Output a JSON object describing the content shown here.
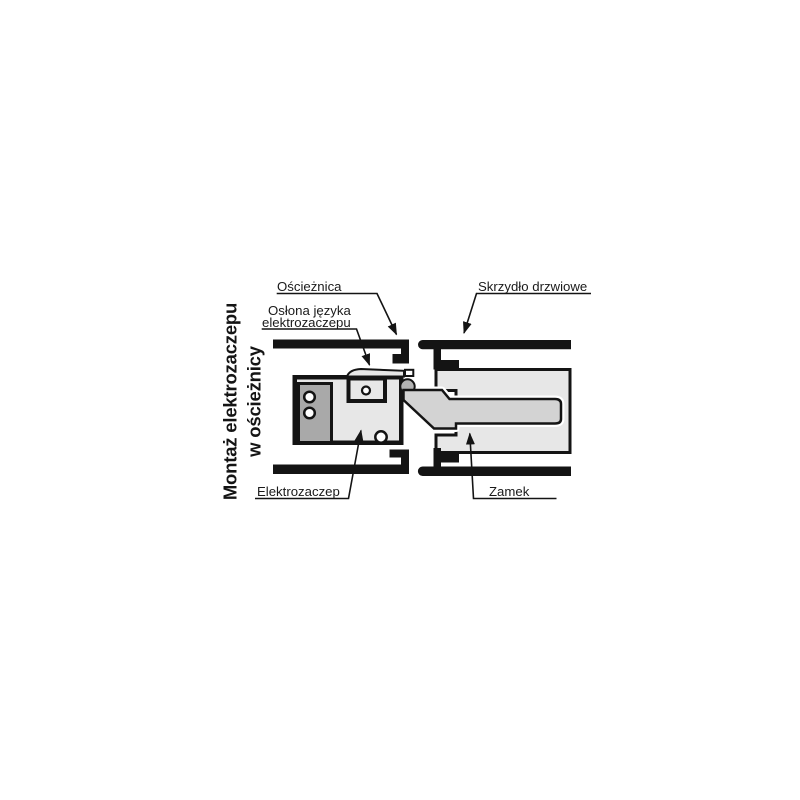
{
  "figure": {
    "title_vertical": {
      "line1": "Montaż elektrozaczepu",
      "line2": "w ościeżnicy"
    },
    "callouts": {
      "frame": "Ościeżnica",
      "latch_cover": {
        "line1": "Osłona języka",
        "line2": "elektrozaczepu"
      },
      "door_leaf": "Skrzydło drzwiowe",
      "electric_strike": "Elektrozaczep",
      "lock": "Zamek"
    },
    "colors": {
      "background": "#ffffff",
      "outline": "#141414",
      "component_light_gray": "#e7e7e7",
      "latch_gray": "#d3d3d3",
      "mount_plate_dark_gray": "#a9a9a9",
      "latch_keeper_gray": "#b3b3b3"
    }
  }
}
